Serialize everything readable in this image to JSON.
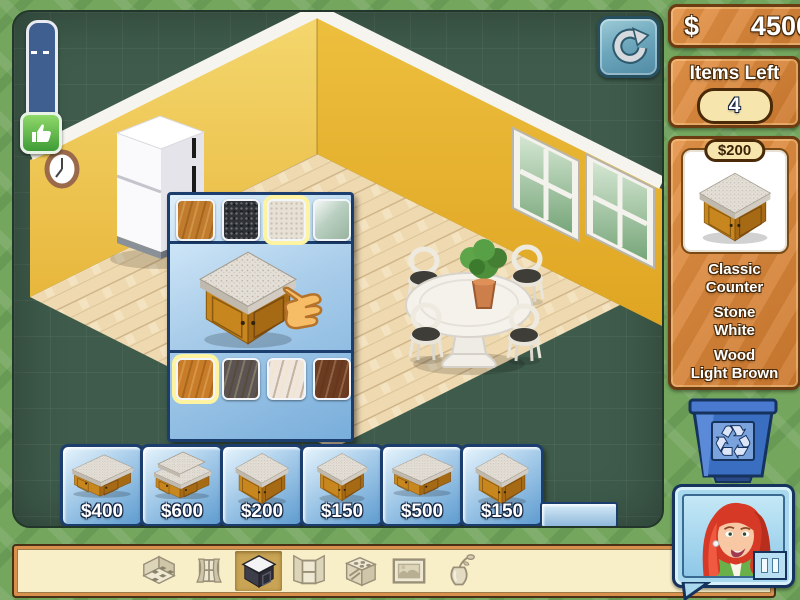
{
  "hud": {
    "money": {
      "currency": "$",
      "amount": "4500"
    },
    "items_left": {
      "label": "Items Left",
      "count": "4"
    }
  },
  "selected_item": {
    "price": "$200",
    "name_lines": [
      "Classic",
      "Counter"
    ],
    "surface_lines": [
      "Stone",
      "White"
    ],
    "finish_lines": [
      "Wood",
      "Light Brown"
    ]
  },
  "customizer": {
    "surface_swatches": [
      {
        "name": "butcher-block",
        "color": "#c07c2c",
        "selected": false
      },
      {
        "name": "black-granite",
        "color": "#2e3136",
        "selected": false
      },
      {
        "name": "white-stone",
        "color": "#e7e0d4",
        "selected": true
      },
      {
        "name": "green-marble",
        "color": "#b9cfc0",
        "selected": false
      }
    ],
    "wood_swatches": [
      {
        "name": "light-brown-wood",
        "color": "#c87c28",
        "selected": true
      },
      {
        "name": "gray-wood",
        "color": "#5a5552",
        "selected": false
      },
      {
        "name": "white-wood",
        "color": "#efe7de",
        "selected": false
      },
      {
        "name": "dark-brown-wood",
        "color": "#6b3b22",
        "selected": false
      }
    ]
  },
  "tray": {
    "items": [
      {
        "price": "$400",
        "shape": "island-counter"
      },
      {
        "price": "$600",
        "shape": "bar-counter"
      },
      {
        "price": "$200",
        "shape": "corner-counter"
      },
      {
        "price": "$150",
        "shape": "small-counter"
      },
      {
        "price": "$500",
        "shape": "long-counter"
      },
      {
        "price": "$150",
        "shape": "curved-counter"
      }
    ]
  },
  "toolbar": {
    "tools": [
      {
        "id": "floors",
        "icon": "floor-tiles-icon",
        "selected": false
      },
      {
        "id": "windows",
        "icon": "curtains-icon",
        "selected": false
      },
      {
        "id": "counters",
        "icon": "counter-icon",
        "selected": true
      },
      {
        "id": "cabinets",
        "icon": "open-cabinet-icon",
        "selected": false
      },
      {
        "id": "appliances",
        "icon": "stove-icon",
        "selected": false
      },
      {
        "id": "decor",
        "icon": "picture-frame-icon",
        "selected": false
      },
      {
        "id": "plants",
        "icon": "vase-icon",
        "selected": false
      }
    ]
  },
  "colors": {
    "background_green": "#74a65e",
    "play_area_green": "#3e5b4b",
    "panel_orange": "#d8843a",
    "tray_blue": "#5e9cd0",
    "border_navy": "#1c3e6e",
    "wall_yellow": "#e9b73a"
  }
}
